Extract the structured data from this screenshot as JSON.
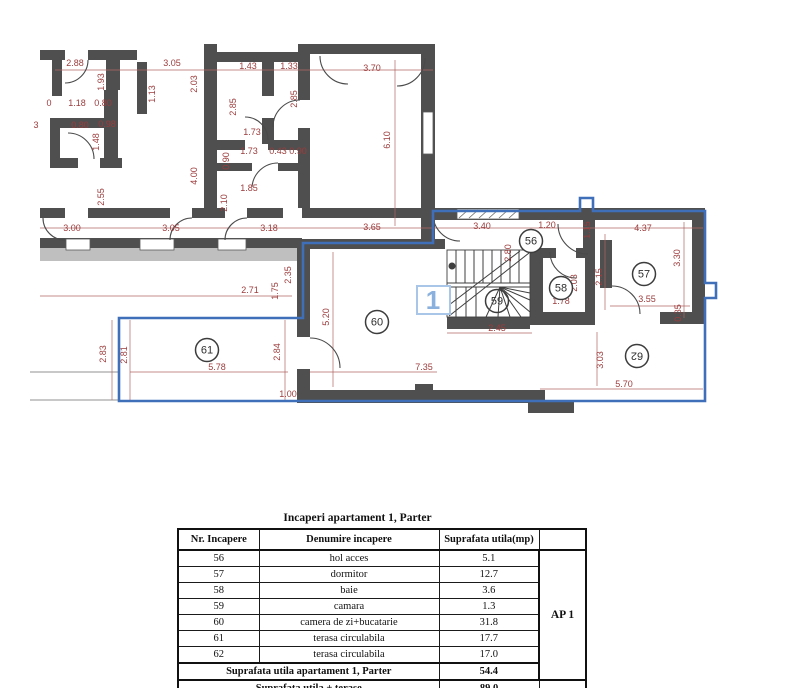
{
  "plan": {
    "marker_box_label": "1",
    "rooms": [
      {
        "n": "56",
        "x": 531,
        "y": 241
      },
      {
        "n": "57",
        "x": 644,
        "y": 274
      },
      {
        "n": "58",
        "x": 561,
        "y": 288
      },
      {
        "n": "59",
        "x": 497,
        "y": 301,
        "behind": true
      },
      {
        "n": "60",
        "x": 377,
        "y": 322
      },
      {
        "n": "61",
        "x": 207,
        "y": 350
      },
      {
        "n": "62",
        "x": 637,
        "y": 356,
        "rot": 180
      }
    ],
    "dims": [
      {
        "t": "2.88",
        "x": 75,
        "y": 66
      },
      {
        "t": "3.05",
        "x": 172,
        "y": 66
      },
      {
        "t": "1.43",
        "x": 248,
        "y": 69
      },
      {
        "t": "1.33",
        "x": 289,
        "y": 69
      },
      {
        "t": "3.70",
        "x": 372,
        "y": 71
      },
      {
        "t": "0",
        "x": 49,
        "y": 106
      },
      {
        "t": "1.18",
        "x": 77,
        "y": 106
      },
      {
        "t": "0.80",
        "x": 103,
        "y": 106
      },
      {
        "t": "3",
        "x": 36,
        "y": 128
      },
      {
        "t": "0.80",
        "x": 80,
        "y": 128
      },
      {
        "t": "0.98",
        "x": 107,
        "y": 127
      },
      {
        "t": "1.73",
        "x": 252,
        "y": 135
      },
      {
        "t": "1.73",
        "x": 249,
        "y": 154
      },
      {
        "t": "0.43",
        "x": 278,
        "y": 154
      },
      {
        "t": "0.90",
        "x": 298,
        "y": 154
      },
      {
        "t": "1.85",
        "x": 249,
        "y": 191
      },
      {
        "t": "3.00",
        "x": 72,
        "y": 231
      },
      {
        "t": "3.05",
        "x": 171,
        "y": 231
      },
      {
        "t": "3.18",
        "x": 269,
        "y": 231
      },
      {
        "t": "3.65",
        "x": 372,
        "y": 230
      },
      {
        "t": "3.40",
        "x": 482,
        "y": 229
      },
      {
        "t": "1.20",
        "x": 547,
        "y": 228
      },
      {
        "t": "4.37",
        "x": 643,
        "y": 231
      },
      {
        "t": "2.71",
        "x": 250,
        "y": 293
      },
      {
        "t": "1.78",
        "x": 561,
        "y": 304
      },
      {
        "t": "3.55",
        "x": 647,
        "y": 302
      },
      {
        "t": "2.45",
        "x": 497,
        "y": 331
      },
      {
        "t": "5.78",
        "x": 217,
        "y": 370
      },
      {
        "t": "7.35",
        "x": 424,
        "y": 370
      },
      {
        "t": "1.00",
        "x": 288,
        "y": 397
      },
      {
        "t": "5.70",
        "x": 624,
        "y": 387
      },
      {
        "t": "1.93",
        "x": 104,
        "y": 82,
        "v": 1
      },
      {
        "t": "2.03",
        "x": 197,
        "y": 84,
        "v": 1
      },
      {
        "t": "1.13",
        "x": 155,
        "y": 94,
        "v": 1
      },
      {
        "t": "2.85",
        "x": 236,
        "y": 107,
        "v": 1
      },
      {
        "t": "2.85",
        "x": 297,
        "y": 99,
        "v": 1
      },
      {
        "t": "1.48",
        "x": 99,
        "y": 142,
        "v": 1
      },
      {
        "t": "2.55",
        "x": 104,
        "y": 197,
        "v": 1
      },
      {
        "t": "4.00",
        "x": 197,
        "y": 176,
        "v": 1
      },
      {
        "t": "0.90",
        "x": 229,
        "y": 161,
        "v": 1
      },
      {
        "t": "2.10",
        "x": 227,
        "y": 203,
        "v": 1
      },
      {
        "t": "6.10",
        "x": 390,
        "y": 140,
        "v": 1
      },
      {
        "t": "1.15",
        "x": 590,
        "y": 230,
        "v": 1
      },
      {
        "t": "2.80",
        "x": 511,
        "y": 253,
        "v": 1
      },
      {
        "t": "2.15",
        "x": 602,
        "y": 277,
        "v": 1
      },
      {
        "t": "2.03",
        "x": 577,
        "y": 283,
        "v": 1
      },
      {
        "t": "3.30",
        "x": 680,
        "y": 258,
        "v": 1
      },
      {
        "t": "0.35",
        "x": 681,
        "y": 313,
        "v": 1
      },
      {
        "t": "5.20",
        "x": 329,
        "y": 317,
        "v": 1
      },
      {
        "t": "1.75",
        "x": 278,
        "y": 291,
        "v": 1
      },
      {
        "t": "2.35",
        "x": 291,
        "y": 275,
        "v": 1
      },
      {
        "t": "2.83",
        "x": 106,
        "y": 354,
        "v": 1
      },
      {
        "t": "2.81",
        "x": 127,
        "y": 355,
        "v": 1
      },
      {
        "t": "2.84",
        "x": 280,
        "y": 352,
        "v": 1
      },
      {
        "t": "3.03",
        "x": 603,
        "y": 360,
        "v": 1
      }
    ]
  },
  "table": {
    "title": "Incaperi apartament 1, Parter",
    "headers": [
      "Nr. Incapere",
      "Denumire incapere",
      "Suprafata utila(mp)"
    ],
    "group_label": "AP 1",
    "rows": [
      [
        "56",
        "hol acces",
        "5.1"
      ],
      [
        "57",
        "dormitor",
        "12.7"
      ],
      [
        "58",
        "baie",
        "3.6"
      ],
      [
        "59",
        "camara",
        "1.3"
      ],
      [
        "60",
        "camera de zi+bucatarie",
        "31.8"
      ],
      [
        "61",
        "terasa circulabila",
        "17.7"
      ],
      [
        "62",
        "terasa circulabila",
        "17.0"
      ]
    ],
    "footer": [
      {
        "label": "Suprafata utila apartament 1,  Parter",
        "value": "54.4"
      },
      {
        "label": "Suprafata utila + terase",
        "value": "89.0"
      }
    ]
  },
  "colors": {
    "wall": "#4f4f4f",
    "wall_light": "#bfbfbf",
    "dimension": "#9c3c3c",
    "apartment_outline": "#3e6fb8",
    "marker_blue": "#8ab1dd"
  }
}
